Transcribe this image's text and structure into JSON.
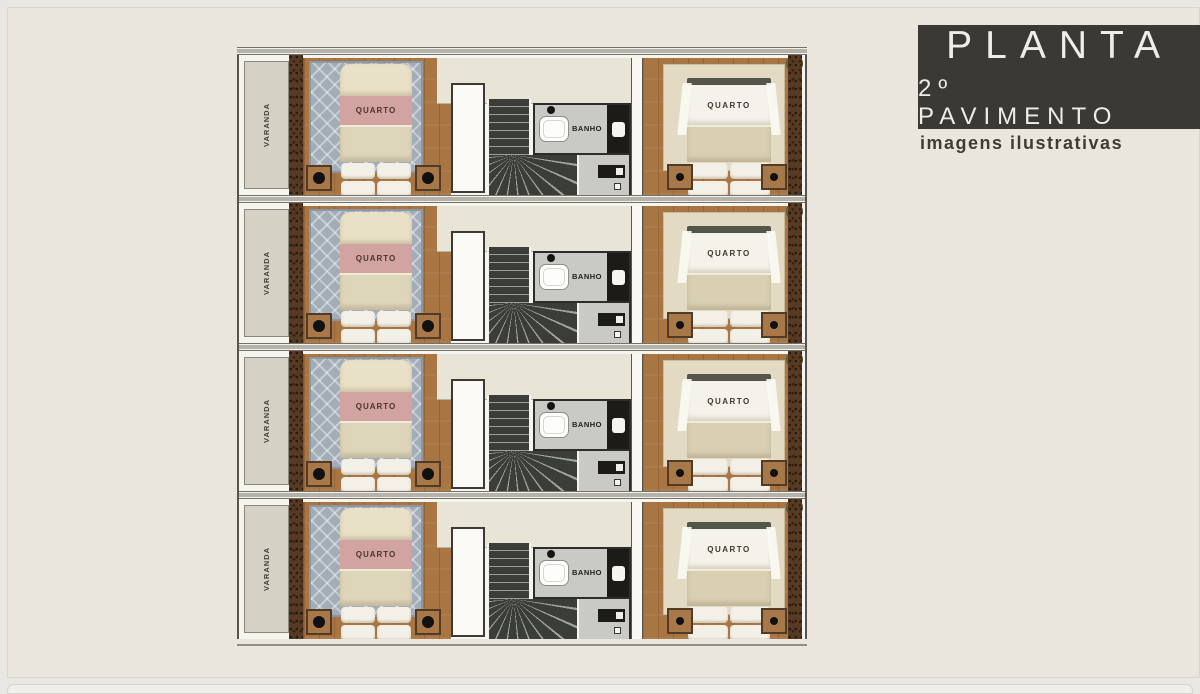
{
  "header": {
    "title": "PLANTA",
    "subtitle": "2º PAVIMENTO",
    "note": "imagens ilustrativas"
  },
  "plan": {
    "units": [
      {
        "varanda_label": "VARANDA",
        "bedroom_left_label": "QUARTO",
        "bathroom_label": "BANHO",
        "bedroom_right_label": "QUARTO"
      },
      {
        "varanda_label": "VARANDA",
        "bedroom_left_label": "QUARTO",
        "bathroom_label": "BANHO",
        "bedroom_right_label": "QUARTO"
      },
      {
        "varanda_label": "VARANDA",
        "bedroom_left_label": "QUARTO",
        "bathroom_label": "BANHO",
        "bedroom_right_label": "QUARTO"
      },
      {
        "varanda_label": "VARANDA",
        "bedroom_left_label": "QUARTO",
        "bathroom_label": "BANHO",
        "bedroom_right_label": "QUARTO"
      }
    ]
  },
  "colors": {
    "background": "#ebe6dd",
    "header_box": "#3a3935",
    "header_text": "#efedea",
    "varanda_floor": "#d5d1c5",
    "wall_brown": "#573a22",
    "wood_floor": "#a97542",
    "rug_gray": "#a3adb8",
    "bed_pink": "#d2a4a1",
    "bed_cream": "#e9e1c7",
    "pillow_white": "#f3f0e7",
    "stairs_dark": "#3b3d38",
    "bath_floor": "#c9c9c6",
    "fixture_black": "#1c1b18",
    "rug_beige": "#e2dac2",
    "blanket_beige": "#d9d0b4",
    "top_floor": "#e9e5d6",
    "plant_green": "#5c6b3d"
  }
}
